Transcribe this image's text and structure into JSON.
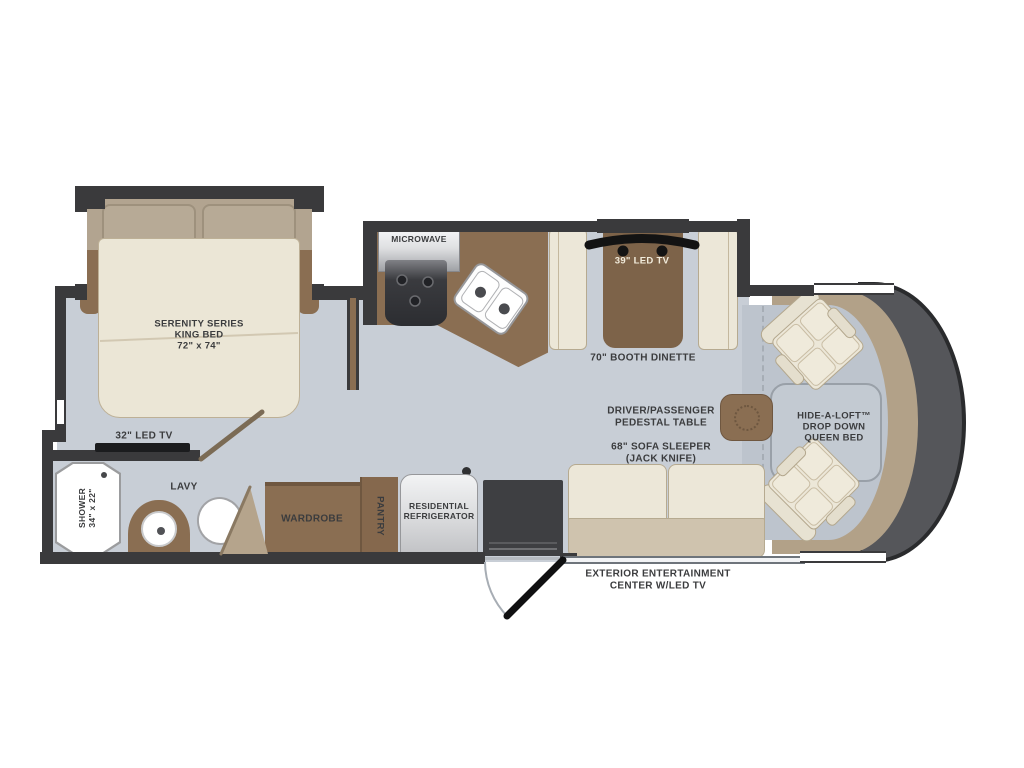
{
  "meta": {
    "title": "RV Motorhome Floor Plan",
    "view": "top-down floorplan"
  },
  "palette": {
    "wall": "#3a3a3c",
    "floor": "#c8ced6",
    "cab_floor": "#bdc4cd",
    "wood_brown": "#8a6e52",
    "wood_dark": "#7d6349",
    "furniture_cream": "#ece7d8",
    "seat_tan": "#cfc3ae",
    "headboard_taupe": "#b2a490",
    "dash_tan": "#b2a188",
    "front_cap_gray": "#55565a",
    "label_text": "#3b3c3e"
  },
  "labels": {
    "king_bed": "SERENITY SERIES\nKING BED\n72\" x 74\"",
    "bedroom_tv": "32\" LED TV",
    "microwave": "MICROWAVE",
    "dinette_tv": "39\" LED TV",
    "booth_dinette": "70\" BOOTH DINETTE",
    "pedestal_table": "DRIVER/PASSENGER\nPEDESTAL TABLE",
    "sofa": "68\" SOFA SLEEPER\n(JACK KNIFE)",
    "hide_a_loft": "HIDE-A-LOFT™\nDROP DOWN\nQUEEN BED",
    "lavy": "LAVY",
    "shower": "SHOWER\n34\" x 22\"",
    "wardrobe": "WARDROBE",
    "pantry": "PANTRY",
    "refrigerator": "RESIDENTIAL\nREFRIGERATOR",
    "exterior_entertainment": "EXTERIOR ENTERTAINMENT\nCENTER W/LED TV"
  }
}
